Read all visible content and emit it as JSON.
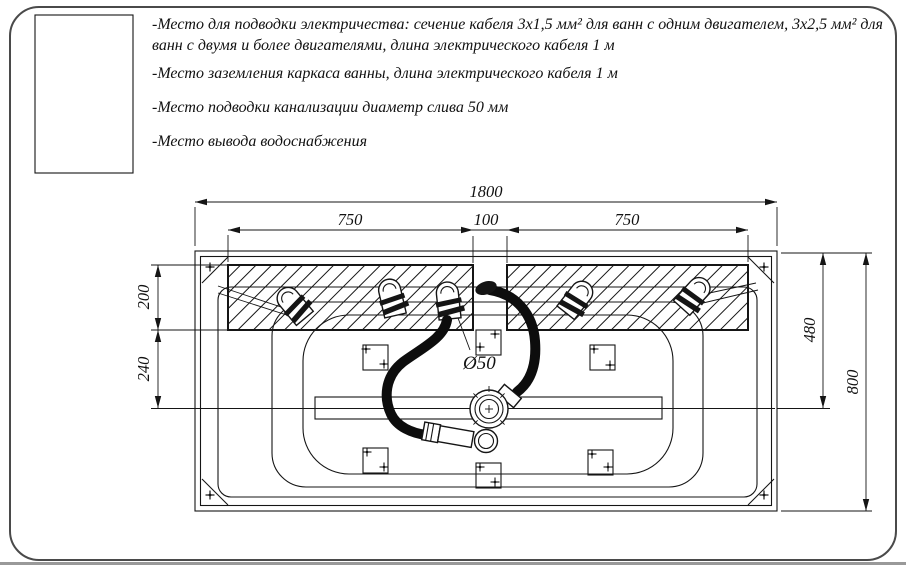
{
  "page": {
    "background": "#ffffff",
    "border_color": "#4a4a4a",
    "line_color": "#151515",
    "bottom_bar_color": "#999999"
  },
  "legend": {
    "swatch": "hatched-rectangle"
  },
  "notes": {
    "electric": "-Место для подводки электричества: сечение кабеля 3х1,5 мм² для ванн с одним двигателем, 3х2,5 мм² для ванн с двумя и более двигателями, длина электрического кабеля 1 м",
    "grounding": "-Место заземления каркаса ванны, длина электрического кабеля 1 м",
    "drainage": "-Место подводки канализации диаметр слива 50 мм",
    "water_supply": "-Место вывода водоснабжения"
  },
  "drawing": {
    "dims": {
      "overall_width": "1800",
      "left_jet_span": "750",
      "drain_gap": "100",
      "right_jet_span": "750",
      "zone_height": "200",
      "zone_to_drain": "240",
      "rim_to_drain": "480",
      "overall_depth": "800",
      "drain_diameter": "Ø50"
    }
  }
}
